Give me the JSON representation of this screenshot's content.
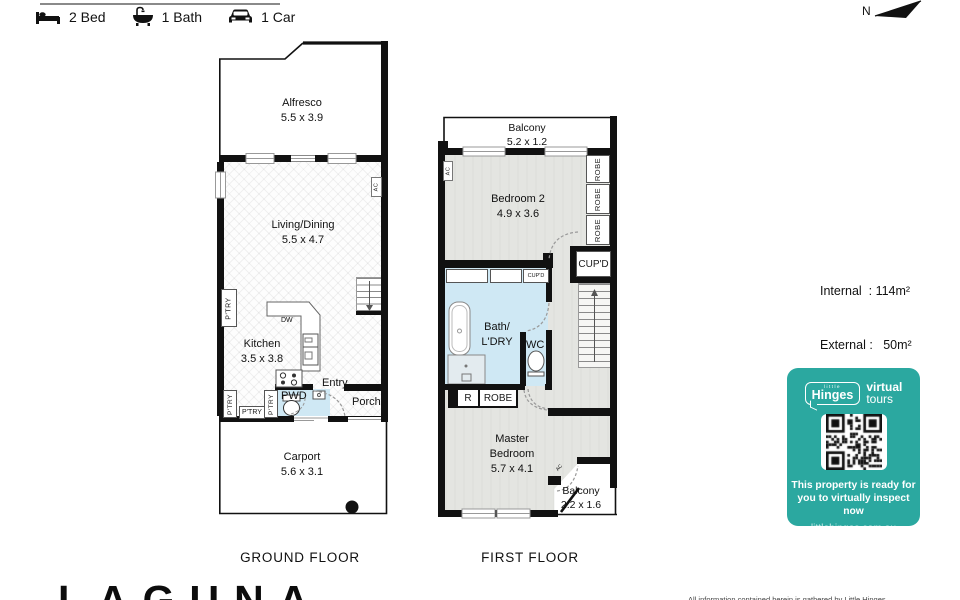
{
  "header": {
    "bed": "2 Bed",
    "bath": "1 Bath",
    "car": "1 Car",
    "north": "N"
  },
  "stats": {
    "internal": "Internal  : 114m²",
    "external": "External :   50m²"
  },
  "ground": {
    "title": "GROUND FLOOR",
    "alfresco_name": "Alfresco",
    "alfresco_dims": "5.5 x 3.9",
    "living_name": "Living/Dining",
    "living_dims": "5.5 x 4.7",
    "kitchen_name": "Kitchen",
    "kitchen_dims": "3.5 x 3.8",
    "carport_name": "Carport",
    "carport_dims": "5.6 x 3.1",
    "pwd": "PWD",
    "entry": "Entry",
    "porch": "Porch",
    "dw": "DW",
    "ac": "AC",
    "ptry": "P'TRY"
  },
  "first": {
    "title": "FIRST FLOOR",
    "balcony1_name": "Balcony",
    "balcony1_dims": "5.2 x 1.2",
    "bed2_name": "Bedroom 2",
    "bed2_dims": "4.9 x 3.6",
    "bath_line1": "Bath/",
    "bath_line2": "L'DRY",
    "wc": "WC",
    "robe": "ROBE",
    "r": "R",
    "cupd": "CUP'D",
    "ac": "AC",
    "master_line1": "Master",
    "master_line2": "Bedroom",
    "master_dims": "5.7 x 4.1",
    "balcony2_name": "Balcony",
    "balcony2_dims": "2.2 x 1.6"
  },
  "badge": {
    "little": "little",
    "hinges": "Hinges",
    "virtual": "virtual",
    "tours": "tours",
    "message_line1": "This property is ready for",
    "message_line2": "you to virtually inspect now",
    "url": "littlehinges.com.au",
    "teal": "#2BA8A0"
  },
  "colors": {
    "wall": "#111111",
    "carpet": "#e4e5e1",
    "wet_area": "#cfe8f4",
    "accent_teal": "#2BA8A0"
  },
  "footer": {
    "logo": "LAGUNA",
    "disclaimer": "All information contained herein is gathered by Little Hinges"
  }
}
